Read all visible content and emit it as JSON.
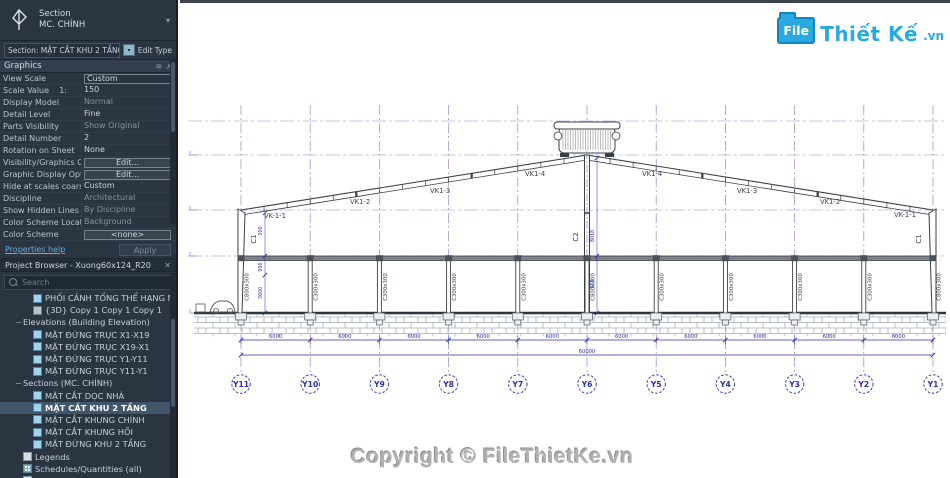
{
  "icons": {
    "dropdown": "▾",
    "close": "✕",
    "collapse": "∧",
    "panel_menu": "≋",
    "minus": "−",
    "plus": "+"
  },
  "type_selector": {
    "category": "Section",
    "type_name": "MC. CHÍNH"
  },
  "section_bar": {
    "label": "Section: MẶT CẮT KHU 2 TẦNG",
    "edit_type": "Edit Type"
  },
  "properties": {
    "group": "Graphics",
    "rows": [
      {
        "label": "View Scale",
        "value": "Custom",
        "style": "box"
      },
      {
        "label": "Scale Value    1:",
        "value": "150"
      },
      {
        "label": "Display Model",
        "value": "Normal",
        "style": "muted"
      },
      {
        "label": "Detail Level",
        "value": "Fine"
      },
      {
        "label": "Parts Visibility",
        "value": "Show Original",
        "style": "muted"
      },
      {
        "label": "Detail Number",
        "value": "2"
      },
      {
        "label": "Rotation on Sheet",
        "value": "None"
      },
      {
        "label": "Visibility/Graphics Ov...",
        "value": "Edit...",
        "style": "btn"
      },
      {
        "label": "Graphic Display Options",
        "value": "Edit...",
        "style": "btn"
      },
      {
        "label": "Hide at scales coarser ...",
        "value": "Custom"
      },
      {
        "label": "Discipline",
        "value": "Architectural",
        "style": "muted"
      },
      {
        "label": "Show Hidden Lines",
        "value": "By Discipline",
        "style": "muted"
      },
      {
        "label": "Color Scheme Location",
        "value": "Background",
        "style": "muted"
      },
      {
        "label": "Color Scheme",
        "value": "<none>",
        "style": "btn"
      }
    ],
    "help": "Properties help",
    "apply": "Apply"
  },
  "browser": {
    "title": "Project Browser - Xuong60x124_R20",
    "search_placeholder": "Search",
    "items": [
      {
        "indent": 2,
        "icon": "view-icon",
        "label": "PHỐI CẢNH TỔNG THỂ HẠNG MỤC"
      },
      {
        "indent": 2,
        "icon": "view3d-icon",
        "label": "{3D} Copy 1 Copy 1 Copy 1"
      },
      {
        "indent": 1,
        "exp": "minus",
        "label": "Elevations (Building Elevation)"
      },
      {
        "indent": 2,
        "icon": "view-icon",
        "label": "MẶT ĐỨNG TRỤC X1-X19"
      },
      {
        "indent": 2,
        "icon": "view-icon",
        "label": "MẶT ĐỨNG TRỤC X19-X1"
      },
      {
        "indent": 2,
        "icon": "view-icon",
        "label": "MẶT ĐỨNG TRỤC Y1-Y11"
      },
      {
        "indent": 2,
        "icon": "view-icon",
        "label": "MẶT ĐỨNG TRỤC Y11-Y1"
      },
      {
        "indent": 1,
        "exp": "minus",
        "label": "Sections (MC. CHÍNH)"
      },
      {
        "indent": 2,
        "icon": "view-icon",
        "label": "MẶT CẮT DỌC NHÀ"
      },
      {
        "indent": 2,
        "icon": "view-icon",
        "label": "MẶT CẮT KHU 2 TẦNG",
        "selected": true
      },
      {
        "indent": 2,
        "icon": "view-icon",
        "label": "MẶT CẮT KHUNG CHÍNH"
      },
      {
        "indent": 2,
        "icon": "view-icon",
        "label": "MẶT CẮT KHUNG HỒI"
      },
      {
        "indent": 2,
        "icon": "view-icon",
        "label": "MẶT ĐỨNG KHU 2 TẦNG"
      },
      {
        "indent": 1,
        "icon": "legend-icon",
        "label": "Legends"
      },
      {
        "indent": 1,
        "icon": "schedule-icon",
        "label": "Schedules/Quantities (all)"
      },
      {
        "indent": 1,
        "icon": "sheet-icon",
        "label": "Sheets (all)"
      },
      {
        "indent": 1,
        "exp": "plus",
        "icon": "sheet-icon",
        "label": "A-100 - PHỐI CẢNH TỔNG THỂ"
      }
    ]
  },
  "drawing": {
    "grid_labels": [
      "Y11",
      "Y10",
      "Y9",
      "Y8",
      "Y7",
      "Y6",
      "Y5",
      "Y4",
      "Y3",
      "Y2",
      "Y1"
    ],
    "bay_dim": "6000",
    "total_dim": "60000",
    "rafter_labels": [
      {
        "text": "VK-1-1",
        "x": 84,
        "y": 215
      },
      {
        "text": "VK1-2",
        "x": 170,
        "y": 201
      },
      {
        "text": "VK1-3",
        "x": 250,
        "y": 190
      },
      {
        "text": "VK1-4",
        "x": 345,
        "y": 173
      },
      {
        "text": "VK1-4",
        "x": 462,
        "y": 173
      },
      {
        "text": "VK1-3",
        "x": 557,
        "y": 190
      },
      {
        "text": "VK1-2",
        "x": 640,
        "y": 201
      },
      {
        "text": "VK-1-1",
        "x": 714,
        "y": 214
      }
    ],
    "column_labels": [
      "C800x300",
      "C300x300",
      "C300x300",
      "C300x300",
      "C300x300",
      "C800x300",
      "C300x300",
      "C300x300",
      "C300x300",
      "C300x300",
      "C800x300"
    ],
    "corner_column_label": "C1",
    "center_column_label": "C2",
    "vertical_dims": [
      {
        "text": "300",
        "x": 82,
        "y": 228
      },
      {
        "text": "950",
        "x": 82,
        "y": 264
      },
      {
        "text": "3600",
        "x": 82,
        "y": 290
      },
      {
        "text": "8018",
        "x": 414,
        "y": 233
      },
      {
        "text": "950",
        "x": 414,
        "y": 281
      }
    ]
  },
  "logo": {
    "file": "File",
    "name": "Thiết Kế",
    "tld": ".vn"
  },
  "copyright": "Copyright © FileThietKe.vn"
}
